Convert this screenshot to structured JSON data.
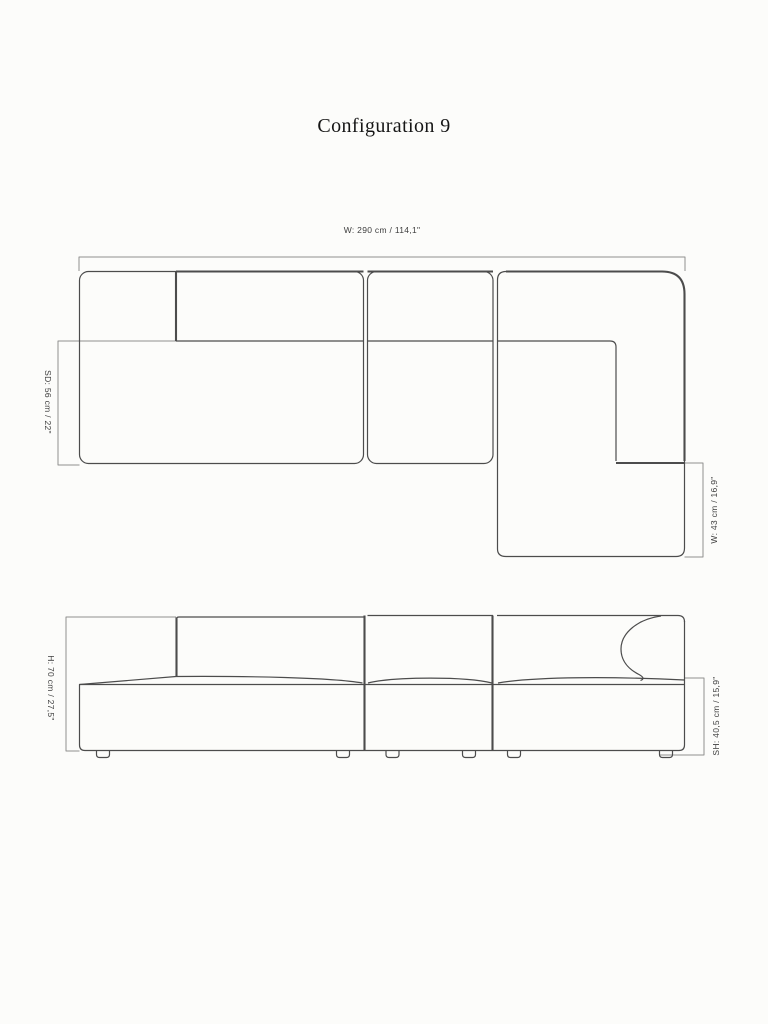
{
  "title": "Configuration 9",
  "colors": {
    "background": "#fcfcfa",
    "outline": "#4c4c4c",
    "dimension_line": "#8f8f8f",
    "label_text": "#3d3d3d",
    "title_text": "#161616"
  },
  "top_view": {
    "dimensions": {
      "overall_width": "W: 290 cm / 114,1\"",
      "seat_depth": "SD: 56 cm / 22\"",
      "chaise_width": "W: 43 cm / 16,9\""
    }
  },
  "front_view": {
    "dimensions": {
      "overall_height": "H: 70 cm / 27,5\"",
      "seat_height": "SH: 40,5 cm / 15,9\""
    }
  }
}
